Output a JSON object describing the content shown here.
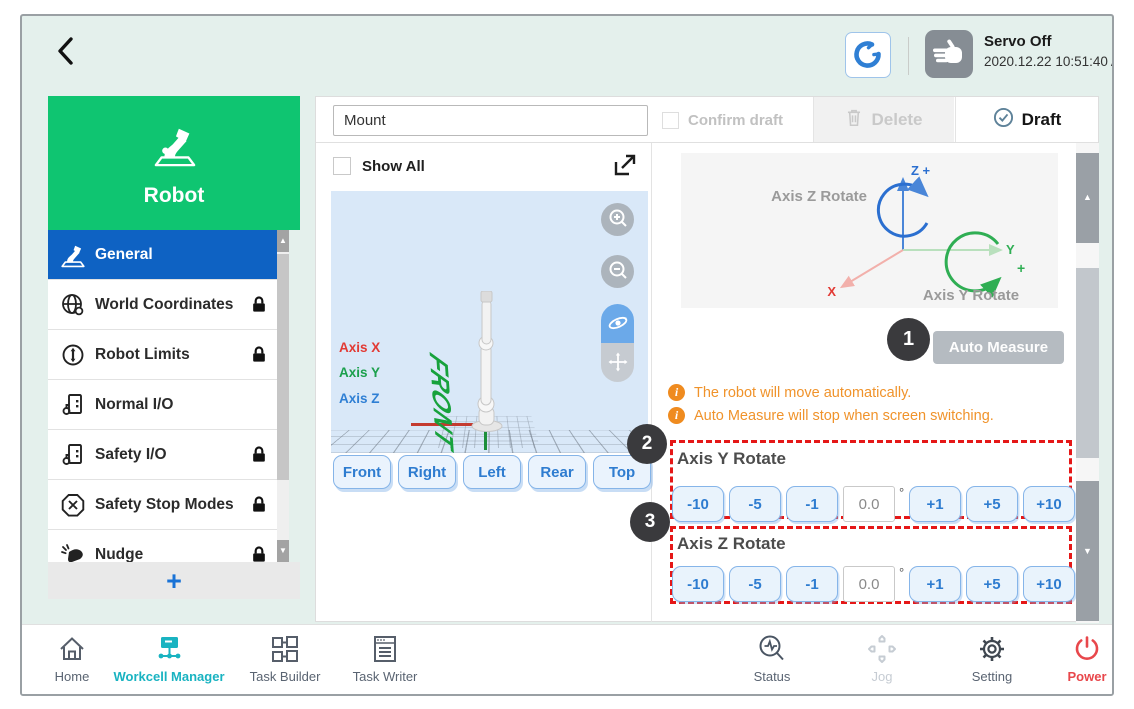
{
  "colors": {
    "brand_green": "#0fc571",
    "selected_blue": "#0e62c3",
    "accent_blue": "#2e7cd0",
    "active_teal": "#19b3c1",
    "warning_orange": "#ef8b1f",
    "annotation_red": "#e51717",
    "power_red": "#e8474b",
    "axis_x_red": "#e23a34",
    "axis_y_green": "#1ca04d",
    "axis_z_blue": "#2f7fd4"
  },
  "top_bar": {
    "servo_status": "Servo Off",
    "timestamp": "2020.12.22 10:51:40 AM"
  },
  "sidebar": {
    "title": "Robot",
    "items": [
      {
        "label": "General",
        "locked": false,
        "active": true
      },
      {
        "label": "World Coordinates",
        "locked": true,
        "active": false
      },
      {
        "label": "Robot Limits",
        "locked": true,
        "active": false
      },
      {
        "label": "Normal I/O",
        "locked": false,
        "active": false
      },
      {
        "label": "Safety I/O",
        "locked": true,
        "active": false
      },
      {
        "label": "Safety Stop Modes",
        "locked": true,
        "active": false
      },
      {
        "label": "Nudge",
        "locked": true,
        "active": false
      }
    ],
    "add_button_label": "+"
  },
  "workcell_header": {
    "name_value": "Mount",
    "confirm_draft_label": "Confirm draft",
    "delete_label": "Delete",
    "draft_label": "Draft"
  },
  "viewer": {
    "show_all_label": "Show All",
    "axis_x_label": "Axis X",
    "axis_y_label": "Axis Y",
    "axis_z_label": "Axis Z",
    "floor_label": "FRONT",
    "view_buttons": [
      "Front",
      "Right",
      "Left",
      "Rear",
      "Top"
    ]
  },
  "measure_panel": {
    "diagram": {
      "axis_z_rotate_label": "Axis Z Rotate",
      "axis_y_rotate_label": "Axis Y Rotate",
      "z_axis_label": "Z +",
      "y_axis_label": "Y",
      "y_plus_label": "+",
      "x_axis_label": "X"
    },
    "auto_measure_label": "Auto Measure",
    "info_glyph": "i",
    "warnings": [
      "The robot will move automatically.",
      "Auto Measure will stop when screen switching."
    ],
    "sections": [
      {
        "title": "Axis Y Rotate",
        "buttons": [
          "-10",
          "-5",
          "-1",
          "+1",
          "+5",
          "+10"
        ],
        "value": "0.0",
        "unit": "°"
      },
      {
        "title": "Axis Z Rotate",
        "buttons": [
          "-10",
          "-5",
          "-1",
          "+1",
          "+5",
          "+10"
        ],
        "value": "0.0",
        "unit": "°"
      }
    ]
  },
  "annotations": [
    "1",
    "2",
    "3"
  ],
  "bottom_bar": {
    "items": [
      {
        "label": "Home",
        "state": "normal"
      },
      {
        "label": "Workcell Manager",
        "state": "active"
      },
      {
        "label": "Task Builder",
        "state": "normal"
      },
      {
        "label": "Task Writer",
        "state": "normal"
      },
      {
        "label": "Status",
        "state": "normal"
      },
      {
        "label": "Jog",
        "state": "disabled"
      },
      {
        "label": "Setting",
        "state": "normal"
      },
      {
        "label": "Power",
        "state": "power"
      }
    ]
  }
}
